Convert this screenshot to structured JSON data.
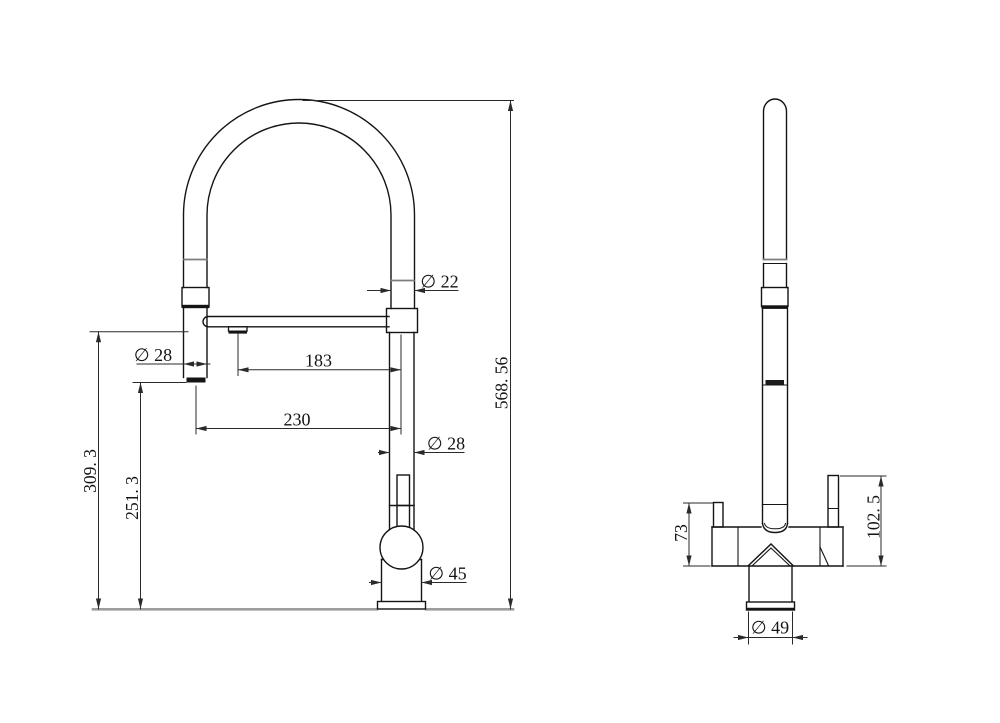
{
  "drawing": {
    "type": "technical-dimension-drawing",
    "subject": "pull-down kitchen faucet, front and side orthographic views",
    "background_color": "#ffffff",
    "outline_color": "#141414",
    "dimension_line_color": "#2a2a2a",
    "ground_line_color": "#9c9c9c"
  },
  "front_view": {
    "dims": {
      "tube_diameter": "∅ 22",
      "spray_head_diameter": "∅ 28",
      "nozzle_offset": "183",
      "spout_reach": "230",
      "column_diameter": "∅ 28",
      "valve_body_diameter": "∅ 45",
      "overall_height": "568. 56",
      "nozzle_height": "309. 3",
      "spray_outlet_height": "251. 3"
    }
  },
  "side_view": {
    "dims": {
      "left_lever_height": "73",
      "right_lever_height": "102. 5",
      "base_diameter": "∅ 49"
    }
  }
}
